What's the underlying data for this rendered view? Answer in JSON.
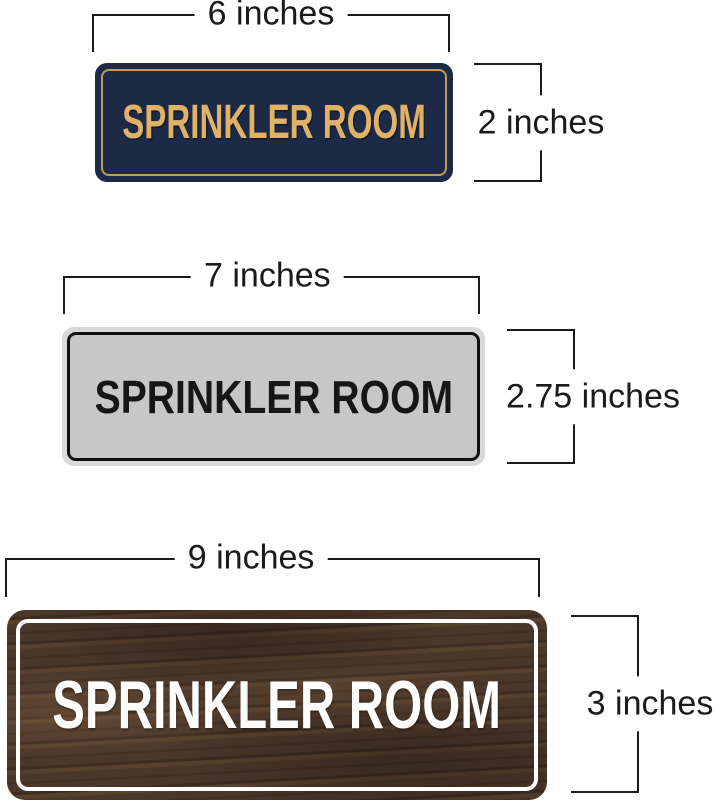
{
  "page": {
    "background_color": "#ffffff",
    "dimension_color": "#1a1a1a",
    "description": "Size comparison of three SPRINKLER ROOM door signs with width and height dimension annotations"
  },
  "signs": [
    {
      "style": "navy-gold",
      "text": "SPRINKLER ROOM",
      "width_label": "6 inches",
      "height_label": "2 inches",
      "colors": {
        "face": "#1c2a48",
        "border": "#c49a58",
        "text": "#dfb267"
      }
    },
    {
      "style": "silver-black",
      "text": "SPRINKLER ROOM",
      "width_label": "7 inches",
      "height_label": "2.75 inches",
      "colors": {
        "face": "#c7c7c7",
        "edge": "#d9d9d9",
        "border": "#101010",
        "text": "#161616"
      }
    },
    {
      "style": "walnut-white",
      "text": "SPRINKLER ROOM",
      "width_label": "9 inches",
      "height_label": "3 inches",
      "colors": {
        "face": "#4b372a",
        "border": "#ffffff",
        "text": "#ffffff"
      }
    }
  ]
}
